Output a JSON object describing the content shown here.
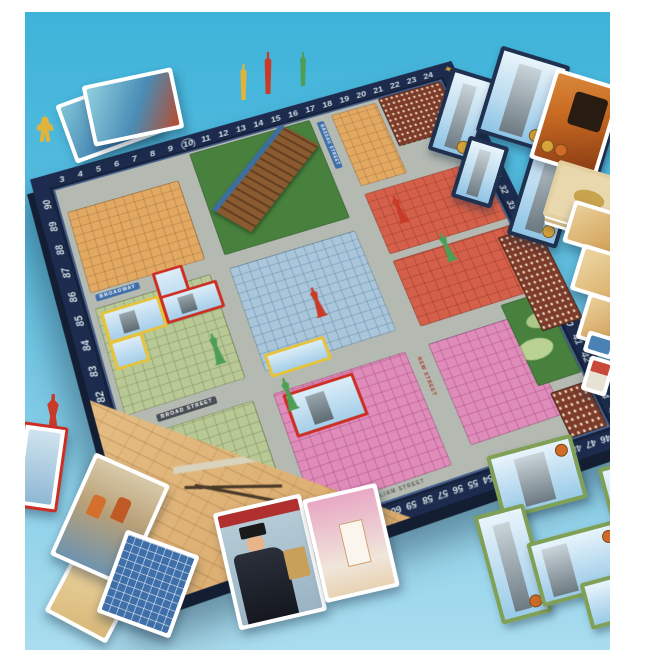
{
  "meta": {
    "subject": "New York 1901 city-building board game laid out on a blue backdrop",
    "view": "angled product photo"
  },
  "palette": {
    "backdrop_top": "#3eb3d9",
    "backdrop_bottom": "#a9dcee",
    "frame": "#ffffff",
    "board_border": "#1d2c4e",
    "track_number_color": "#d4e4f2",
    "street_gray": "#b4bab2",
    "district_orange": "#e2a963",
    "district_salmon": "#d4604a",
    "district_blue": "#a9c6da",
    "district_pink": "#df8cba",
    "district_sage": "#b9c996",
    "park_green": "#47813d",
    "tile_yellow_border": "#e6c33a",
    "tile_red_border": "#cc2e24",
    "tile_navy_border": "#20304f",
    "tile_green_border": "#7fa055",
    "piece_yellow": "#e0b33c",
    "piece_red": "#c93a28",
    "piece_green": "#4f9e55"
  },
  "board": {
    "track": {
      "top": [
        "3",
        "4",
        "5",
        "6",
        "7",
        "8",
        "9",
        "10",
        "11",
        "12",
        "13",
        "14",
        "15",
        "16",
        "17",
        "18",
        "19",
        "20",
        "21",
        "22",
        "23",
        "24"
      ],
      "right": [
        "25",
        "26",
        "27",
        "28",
        "29",
        "30",
        "31",
        "32",
        "33",
        "34",
        "35",
        "36",
        "37",
        "38",
        "39",
        "40",
        "41",
        "42",
        "43",
        "44",
        "45"
      ],
      "bottom": [
        "46",
        "47",
        "48",
        "49",
        "50",
        "51",
        "52",
        "53",
        "54",
        "55",
        "56",
        "57",
        "58",
        "59",
        "60",
        "61",
        "62",
        "63",
        "64",
        "65",
        "66",
        "67",
        "68",
        "69",
        "70",
        "71",
        "72",
        "73",
        "74"
      ],
      "left": [
        "76",
        "77",
        "78",
        "79",
        "80",
        "81",
        "82",
        "83",
        "84",
        "85",
        "86",
        "87",
        "88",
        "89",
        "90"
      ],
      "corner": "75",
      "circled": "10"
    },
    "streets": {
      "broadway": "BROADWAY",
      "broad": "BROAD STREET",
      "nassau": "NASSAU STREET",
      "new_street": "NEW STREET",
      "william": "WILLIAM STREET"
    }
  },
  "icons": {
    "compass_rose": "✦"
  }
}
